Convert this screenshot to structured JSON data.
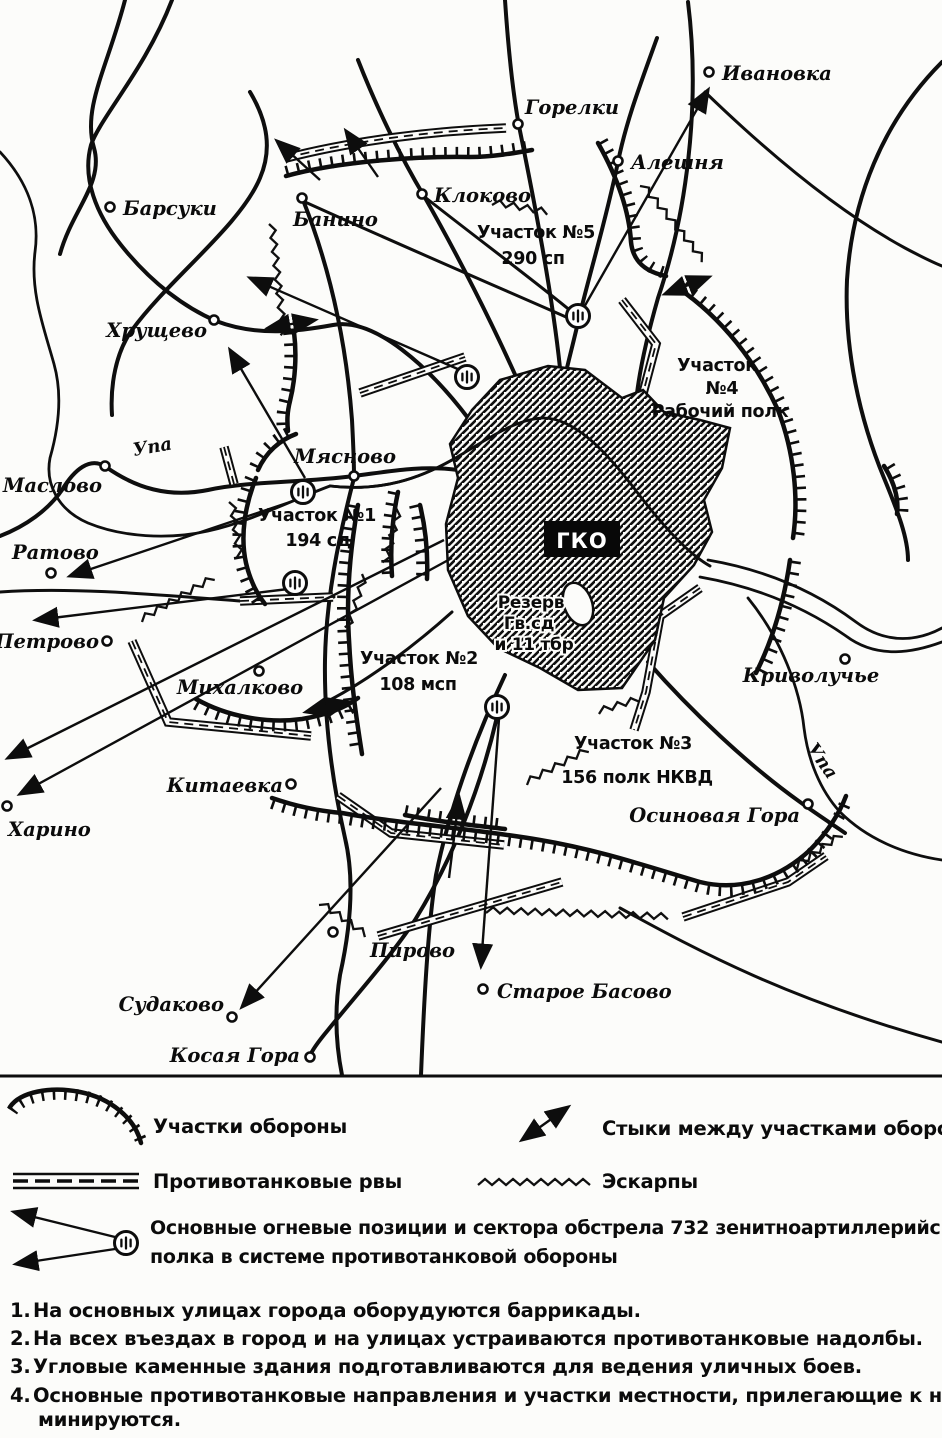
{
  "map": {
    "places": [
      {
        "name": "Ивановка"
      },
      {
        "name": "Горелки"
      },
      {
        "name": "Алешня"
      },
      {
        "name": "Клоково"
      },
      {
        "name": "Банино"
      },
      {
        "name": "Барсуки"
      },
      {
        "name": "Хрущево"
      },
      {
        "name": "Маслово"
      },
      {
        "name": "Мясново"
      },
      {
        "name": "Ратово"
      },
      {
        "name": "Петрово"
      },
      {
        "name": "Михалково"
      },
      {
        "name": "Китаевка"
      },
      {
        "name": "Харино"
      },
      {
        "name": "Судаково"
      },
      {
        "name": "Косая Гора"
      },
      {
        "name": "Пирово"
      },
      {
        "name": "Старое Басово"
      },
      {
        "name": "Осиновая Гора"
      },
      {
        "name": "Криволучье"
      }
    ],
    "river_label": "Упа",
    "sectors": {
      "s5": {
        "line1": "Участок №5",
        "line2": "290 сп"
      },
      "s4": {
        "line1": "Участок",
        "line2": "№4",
        "line3": "Рабочий полк"
      },
      "s1": {
        "line1": "Участок №1",
        "line2": "194 сд"
      },
      "s2": {
        "line1": "Участок №2",
        "line2": "108 мсп"
      },
      "s3": {
        "line1": "Участок №3",
        "line2": "156 полк НКВД"
      }
    },
    "city": {
      "hq": "ГКО",
      "reserve": {
        "line1": "Резерв",
        "line2": "Гв.сд",
        "line3": "и 11 тбр"
      }
    }
  },
  "legend": {
    "defense_sectors": "Участки обороны",
    "junctions": "Стыки между участками обороны",
    "antitank_ditches": "Противотанковые рвы",
    "escarpments": "Эскарпы",
    "aa_positions_line1": "Основные огневые позиции и сектора обстрела 732 зенитноартиллерийского",
    "aa_positions_line2": "полка в системе противотанковой обороны"
  },
  "notes": [
    {
      "num": "1.",
      "text": "На основных улицах города оборудуются баррикады."
    },
    {
      "num": "2.",
      "text": "На всех въездах в город и на улицах устраиваются противотанковые надолбы."
    },
    {
      "num": "3.",
      "text": "Угловые каменные здания подготавливаются для ведения уличных боев."
    },
    {
      "num": "4.",
      "text": "Основные противотанковые направления и участки местности, прилегающие к ним,",
      "text2": "минируются."
    }
  ]
}
